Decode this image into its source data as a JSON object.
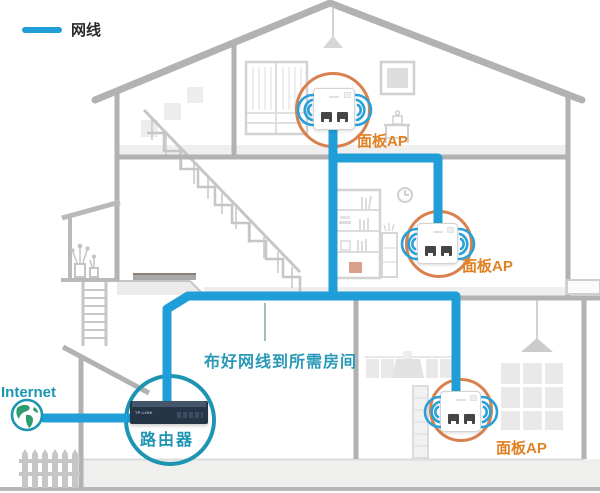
{
  "legend": {
    "label": "网线"
  },
  "internet": {
    "label": "Internet"
  },
  "router": {
    "label": "路由器",
    "brand": "TP-LINK"
  },
  "aps": [
    {
      "label": "面板AP",
      "location": "attic"
    },
    {
      "label": "面板AP",
      "location": "second-floor"
    },
    {
      "label": "面板AP",
      "location": "first-floor"
    }
  ],
  "annotation": {
    "text": "布好网线到所需房间"
  },
  "colors": {
    "cable_blue": "#1f9ed8",
    "wifi_blue": "#2aa0d8",
    "highlight_orange": "#d8814f",
    "label_orange": "#e08124",
    "teal": "#1d95b2",
    "annotation_teal": "#2a99b7",
    "structure_gray": "#b2b2b2",
    "furniture_gray": "#d2d2d2"
  }
}
